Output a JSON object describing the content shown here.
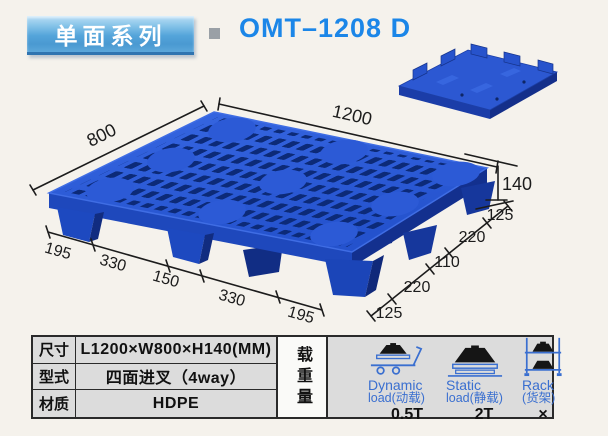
{
  "header": {
    "series_badge": "单面系列",
    "model": "OMT–1208 D"
  },
  "diagram": {
    "top_length": "1200",
    "side_width": "800",
    "height": "140",
    "right_edge_segments": [
      "125",
      "220",
      "110",
      "220",
      "125"
    ],
    "front_edge_segments": [
      "195",
      "330",
      "150",
      "330",
      "195"
    ]
  },
  "spec_table": {
    "rows": [
      {
        "label": "尺寸",
        "value": "L1200×W800×H140(MM)"
      },
      {
        "label": "型式",
        "value": "四面进叉（4way）"
      },
      {
        "label": "材质",
        "value": "HDPE"
      }
    ],
    "load_title": "载重量",
    "load_columns": [
      {
        "line1": "Dynamic",
        "line2": "load(动载)",
        "value": "0.5T"
      },
      {
        "line1": "Static",
        "line2": "load(静载)",
        "value": "2T"
      },
      {
        "line1": "Rack",
        "line2": "(货架)",
        "value": "×"
      }
    ]
  },
  "colors": {
    "title_blue": "#1b86e8",
    "badge_top": "#bbdff5",
    "badge_bottom": "#4a99d1",
    "pallet_blue": "#2a58d8",
    "pallet_hole_navy": "#0c2a78",
    "table_bg": "#dcdcdc",
    "load_label_blue": "#3a6fd0",
    "dimension_line": "#1c1c1c"
  }
}
